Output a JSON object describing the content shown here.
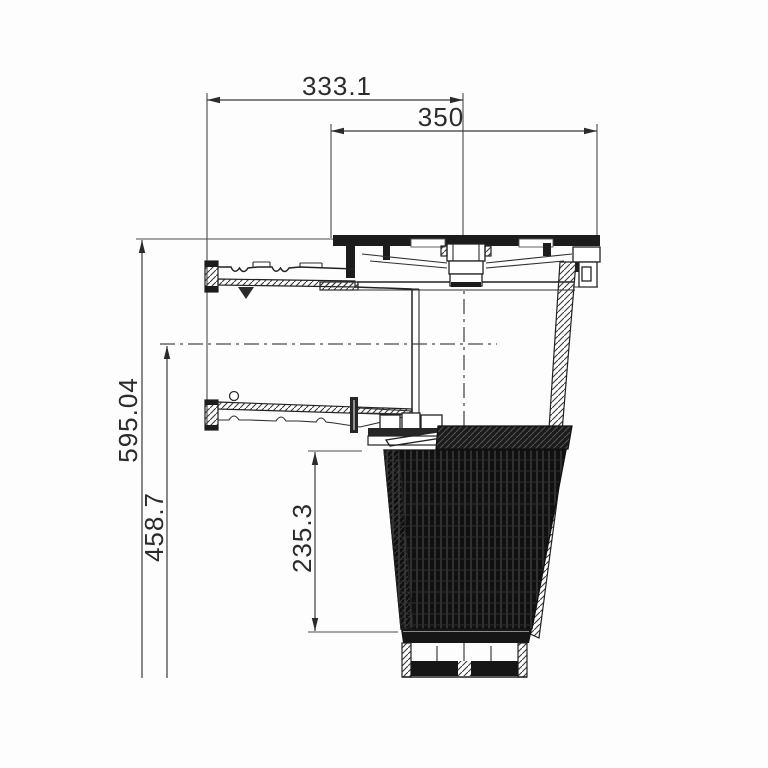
{
  "drawing": {
    "background_color": "#fdfdfd",
    "line_color": "#2b2b2b",
    "dimensions": {
      "flange_to_centerline": "333.1",
      "cover_width": "350",
      "overall_height": "595.04",
      "inlet_centerline_to_bottom": "458.7",
      "basket_height": "235.3"
    }
  }
}
